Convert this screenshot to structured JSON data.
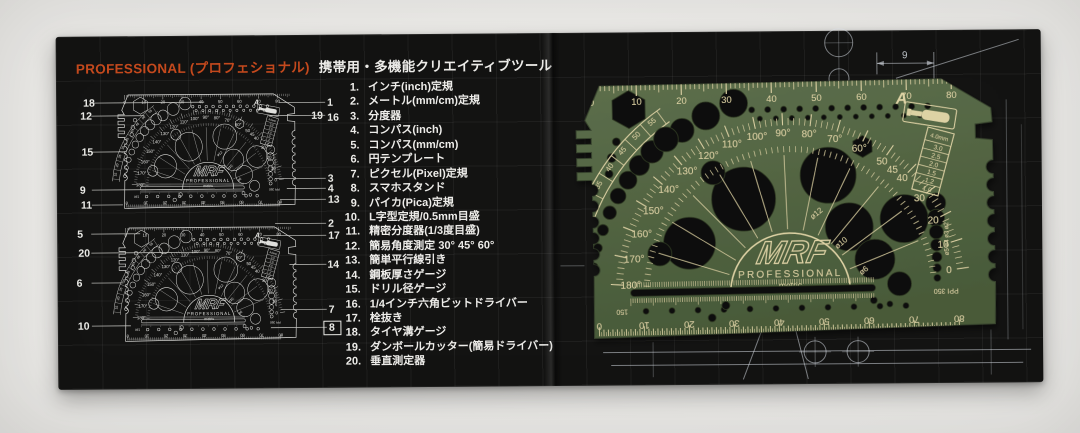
{
  "colors": {
    "background": "#e8e7e3",
    "booklet": "#131312",
    "accent": "#c54a1e",
    "ink": "#edece9",
    "template_body": "#52644?",
    "template_body_top": "#5c6e4b",
    "template_body_bottom": "#485a39",
    "marking": "#ddd2a4",
    "hole": "#0d0d0b"
  },
  "title": {
    "brand": "PROFESSIONAL",
    "brand_kana": "(プロフェショナル)",
    "subtitle": "携帯用・多機能クリエイティブツール"
  },
  "features": [
    {
      "n": "1.",
      "t": "インチ(inch)定規"
    },
    {
      "n": "2.",
      "t": "メートル(mm/cm)定規"
    },
    {
      "n": "3.",
      "t": "分度器"
    },
    {
      "n": "4.",
      "t": "コンパス(inch)"
    },
    {
      "n": "5.",
      "t": "コンパス(mm/cm)"
    },
    {
      "n": "6.",
      "t": "円テンプレート"
    },
    {
      "n": "7.",
      "t": "ピクセル(Pixel)定規"
    },
    {
      "n": "8.",
      "t": "スマホスタンド"
    },
    {
      "n": "9.",
      "t": "パイカ(Pica)定規"
    },
    {
      "n": "10.",
      "t": "L字型定規/0.5mm目盛"
    },
    {
      "n": "11.",
      "t": "精密分度器(1/3度目盛)"
    },
    {
      "n": "12.",
      "t": "簡易角度測定 30° 45° 60°"
    },
    {
      "n": "13.",
      "t": "簡単平行線引き"
    },
    {
      "n": "14.",
      "t": "鋼板厚さゲージ"
    },
    {
      "n": "15.",
      "t": "ドリル径ゲージ"
    },
    {
      "n": "16.",
      "t": "1/4インチ六角ビットドライバー"
    },
    {
      "n": "17.",
      "t": "栓抜き"
    },
    {
      "n": "18.",
      "t": "タイヤ溝ゲージ"
    },
    {
      "n": "19.",
      "t": "ダンボールカッター(簡易ドライバー)"
    },
    {
      "n": "20.",
      "t": "垂直測定器"
    }
  ],
  "diagram_top": {
    "left_labels": [
      "18",
      "12",
      "15",
      "9",
      "11"
    ],
    "right_labels": [
      "1",
      "19",
      "16",
      "3",
      "4",
      "13"
    ]
  },
  "diagram_bottom": {
    "left_labels": [
      "5",
      "20",
      "6",
      "10"
    ],
    "right_labels": [
      "2",
      "17",
      "14",
      "7",
      "8"
    ]
  },
  "template": {
    "logo": "MRF",
    "logo_sub": "PROFESSIONAL",
    "logo_unit": "metric",
    "corner_letter": "A",
    "top_ruler_numbers": [
      "0",
      "10",
      "20",
      "30",
      "40",
      "50",
      "60",
      "70",
      "80"
    ],
    "bottom_ruler_numbers": [
      "0",
      "10",
      "20",
      "30",
      "40",
      "50",
      "60",
      "70",
      "80"
    ],
    "ppi_label": "PPI 350",
    "slot_label": "150",
    "ring_labels": [
      "0",
      "10",
      "20",
      "30",
      "40",
      "45",
      "50",
      "60°",
      "70°",
      "80°",
      "90°",
      "100°",
      "110°",
      "120°",
      "130°",
      "140°",
      "150°",
      "160°",
      "170°",
      "180°"
    ],
    "drill_gauge_labels": [
      "15",
      "20",
      "25",
      "30",
      "35",
      "40",
      "45",
      "50",
      "55"
    ],
    "thickness_gauge": {
      "title": "4.0mm",
      "values": [
        "3.0",
        "2.5",
        "2.0",
        "1.5",
        "1.2",
        "1.0"
      ]
    },
    "circle_labels": [
      "ø12",
      "ø10",
      "ø6"
    ],
    "right_hole_labels": [
      "ø5",
      "ø4",
      "ø3",
      "ø2"
    ]
  },
  "blueprint": {
    "dimension_label": "9"
  }
}
